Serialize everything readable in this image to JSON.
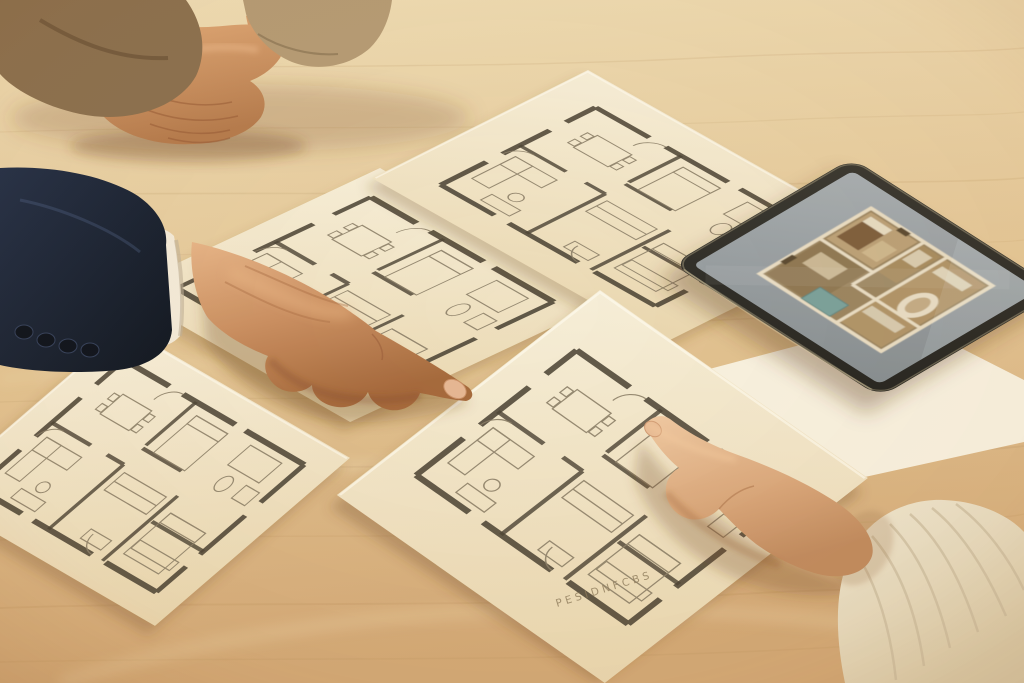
{
  "center_paper": {
    "label": "PESIDNFCBS"
  },
  "colors": {
    "wood_light": "#eedcb4",
    "wood_mid": "#e2c392",
    "wood_dark": "#d2a876",
    "paper_light": "#f6eed8",
    "paper_shade": "#e9d6ae",
    "blank_paper": "#f7f0de",
    "plan_wall": "#4d4536",
    "plan_furniture": "#8b7f68",
    "suit_navy": "#243047",
    "suit_navy_dark": "#10161f",
    "shirt_cuff": "#f2e9d7",
    "khaki_sleeve_left": "#8a6f4e",
    "khaki_sleeve_right": "#b49a74",
    "skin_light": "#e6b487",
    "skin_base": "#ca8f61",
    "skin_dark": "#a5693c",
    "clasped_skin": "#d09468",
    "woman_skin_light": "#efc9a2",
    "woman_skin": "#daa87c",
    "sweater": "#f0e6d0",
    "sweater_shade": "#dccdaa",
    "tablet_frame": "#3a3831",
    "tablet_frame_dark": "#262520",
    "tablet_screen_light": "#a7adb0",
    "tablet_screen_dark": "#868d90",
    "screen_room_tan": "#b09468",
    "screen_wall": "#e8dcc2",
    "screen_teal": "#7aa09a",
    "label_color": "#8d7b5c"
  }
}
